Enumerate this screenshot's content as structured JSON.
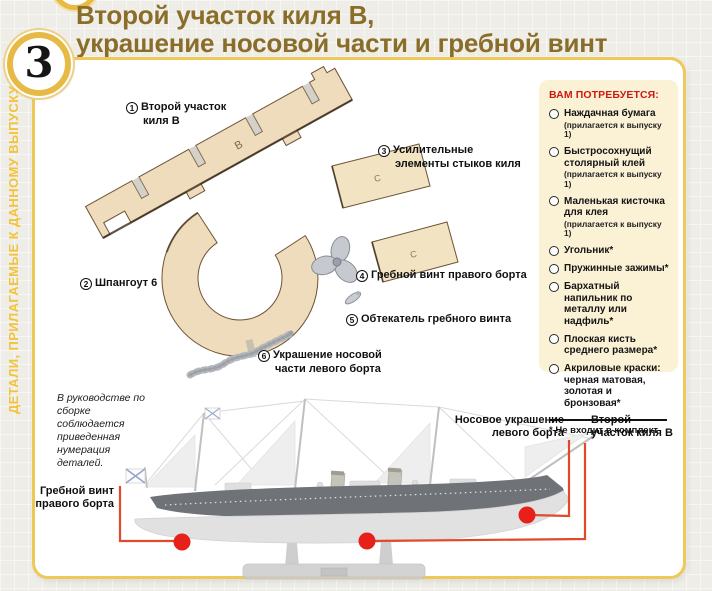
{
  "page": {
    "issue_number": "3",
    "title_line1": "Второй участок киля B,",
    "title_line2": "украшение носовой части и гребной винт",
    "side_strip": "ДЕТАЛИ, ПРИЛАГАЕМЫЕ К ДАННОМУ ВЫПУСКУ"
  },
  "parts": {
    "p1": {
      "num": "1",
      "line1": "Второй участок",
      "line2": "киля B"
    },
    "p2": {
      "num": "2",
      "line1": "Шпангоут 6"
    },
    "p3": {
      "num": "3",
      "line1": "Усилительные",
      "line2": "элементы стыков киля"
    },
    "p4": {
      "num": "4",
      "line1": "Гребной винт правого борта"
    },
    "p5": {
      "num": "5",
      "line1": "Обтекатель гребного винта"
    },
    "p6": {
      "num": "6",
      "line1": "Украшение носовой",
      "line2": "части левого борта"
    }
  },
  "part_letters": {
    "keel": "B",
    "joint1": "C",
    "joint2": "C"
  },
  "sidebar": {
    "title": "ВАМ ПОТРЕБУЕТСЯ:",
    "items": [
      {
        "text": "Наждачная бумага",
        "note": "(прилагается к выпуску 1)"
      },
      {
        "text": "Быстросохнущий столярный клей",
        "note": "(прилагается к выпуску 1)"
      },
      {
        "text": "Маленькая кисточка для клея",
        "note": "(прилагается к выпуску 1)"
      },
      {
        "text": "Угольник*"
      },
      {
        "text": "Пружинные зажимы*"
      },
      {
        "text": "Бархатный напильник по металлу или надфиль*"
      },
      {
        "text": "Плоская кисть среднего размера*"
      },
      {
        "text": "Акриловые краски: черная матовая, золотая и бронзовая*"
      }
    ],
    "footnote": "* Не входит в комплект"
  },
  "note_text": "В руководстве по сборке соблюдается приведенная нумерация деталей.",
  "ship_callouts": {
    "propeller": "Гребной винт правого борта",
    "bow_decoration": "Носовое украшение левого борта",
    "keel_section": "Второй участок киля B"
  },
  "colors": {
    "accent_gold": "#efc85a",
    "title_brown": "#8b6d2a",
    "callout_line_red": "#e0492a",
    "callout_dot_red": "#e7211a",
    "sidebar_bg": "#fbf2d5",
    "sidebar_header_red": "#cc1a12",
    "wood": "#eedcbc"
  }
}
